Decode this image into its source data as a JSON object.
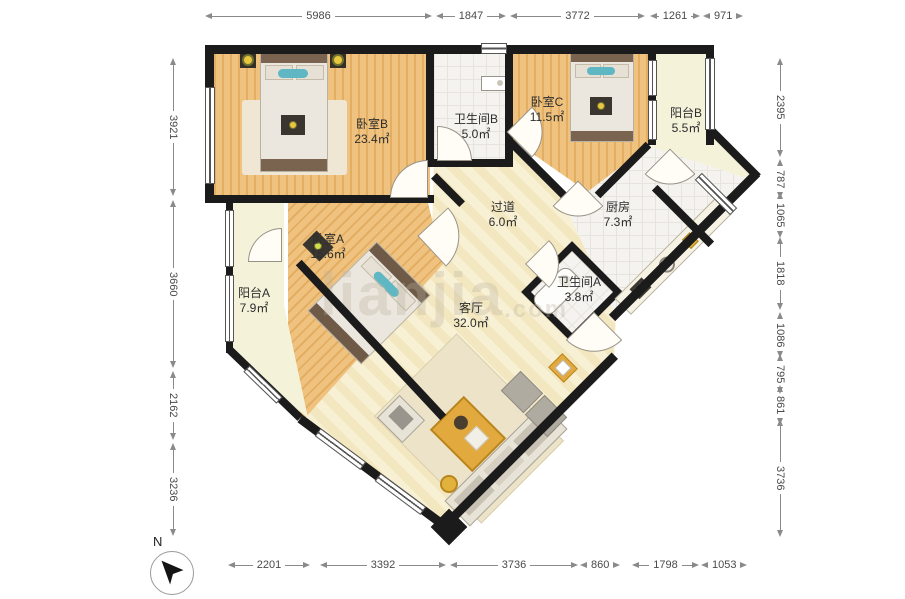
{
  "dims": {
    "top": [
      "5986",
      "1847",
      "3772",
      "1261",
      "971"
    ],
    "bottom": [
      "2201",
      "3392",
      "3736",
      "860",
      "1798",
      "1053"
    ],
    "left": [
      "3921",
      "3660",
      "2162",
      "3236"
    ],
    "right": [
      "2395",
      "787",
      "1065",
      "1818",
      "1086",
      "795",
      "861",
      "3736"
    ]
  },
  "rooms": [
    {
      "name": "卧室B",
      "area": "23.4㎡"
    },
    {
      "name": "卫生间B",
      "area": "5.0㎡"
    },
    {
      "name": "卧室C",
      "area": "11.5㎡"
    },
    {
      "name": "阳台B",
      "area": "5.5㎡"
    },
    {
      "name": "过道",
      "area": "6.0㎡"
    },
    {
      "name": "厨房",
      "area": "7.3㎡"
    },
    {
      "name": "卧室A",
      "area": "15.6㎡"
    },
    {
      "name": "卫生间A",
      "area": "3.8㎡"
    },
    {
      "name": "阳台A",
      "area": "7.9㎡"
    },
    {
      "name": "客厅",
      "area": "32.0㎡"
    }
  ],
  "compass": {
    "n": "N"
  },
  "watermark": {
    "text": "lianjia",
    "suffix": ".com"
  },
  "colors": {
    "wall": "#1b1b1b",
    "wood": "#eabd78",
    "pale_floor": "#f7edc9",
    "balcony": "#f5f2da",
    "tile": "#f4f3ef",
    "accent_yellow": "#e2aa3e",
    "dim_text": "#4a4a4a"
  }
}
